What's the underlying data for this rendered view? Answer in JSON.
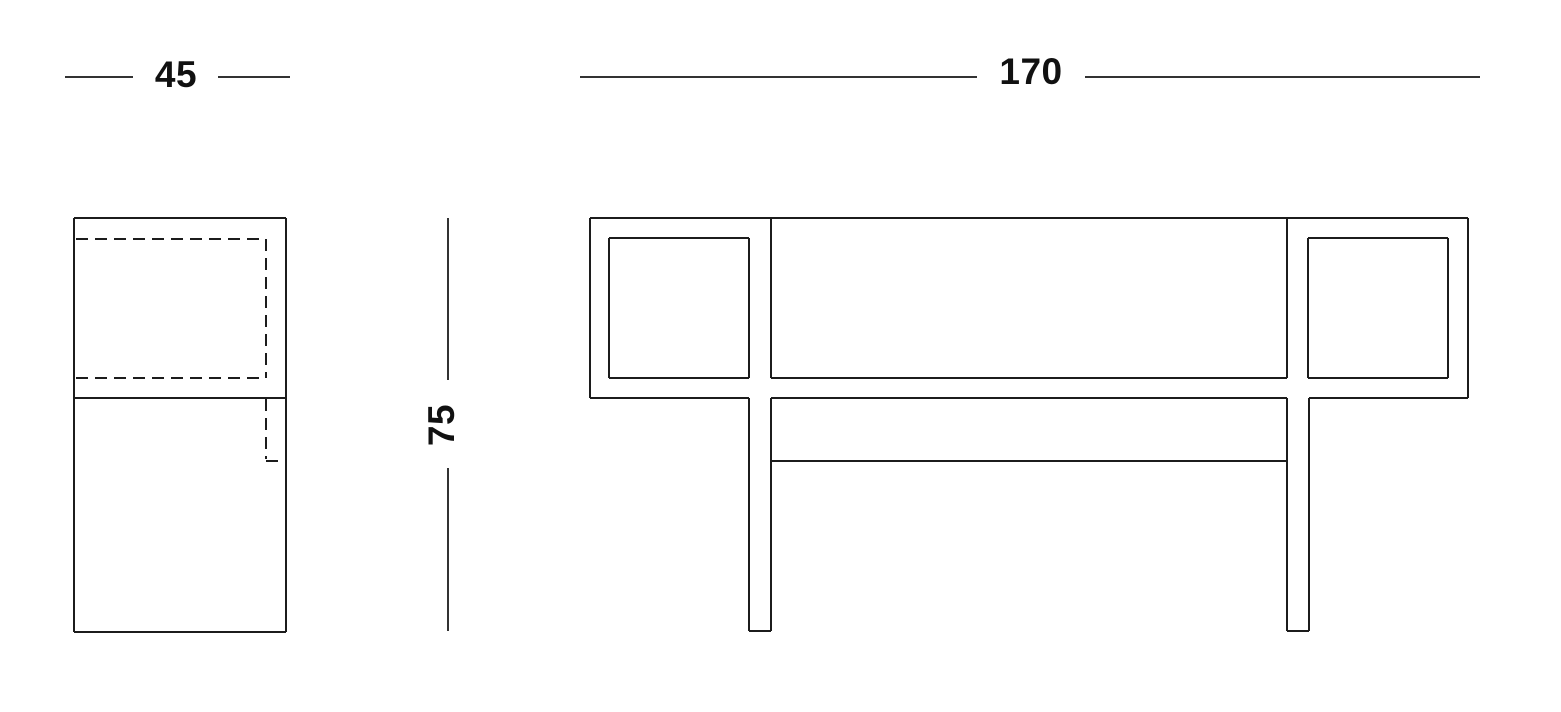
{
  "style": {
    "background": "#ffffff",
    "line_color": "#1c1c1c",
    "dim_line_color": "#333333",
    "text_color": "#111111"
  },
  "dimensions": {
    "depth": {
      "label": "45"
    },
    "length": {
      "label": "170"
    },
    "height": {
      "label": "75"
    }
  },
  "drawing": {
    "side_view": {
      "solid_lines": [
        {
          "x1": 74,
          "y1": 218,
          "x2": 286,
          "y2": 218
        },
        {
          "x1": 74,
          "y1": 218,
          "x2": 74,
          "y2": 632
        },
        {
          "x1": 286,
          "y1": 218,
          "x2": 286,
          "y2": 632
        },
        {
          "x1": 74,
          "y1": 398,
          "x2": 286,
          "y2": 398
        },
        {
          "x1": 74,
          "y1": 632,
          "x2": 286,
          "y2": 632
        }
      ],
      "dashed_lines": [
        {
          "x1": 76,
          "y1": 239,
          "x2": 266,
          "y2": 239
        },
        {
          "x1": 266,
          "y1": 239,
          "x2": 266,
          "y2": 378
        },
        {
          "x1": 76,
          "y1": 378,
          "x2": 266,
          "y2": 378
        },
        {
          "x1": 266,
          "y1": 399,
          "x2": 266,
          "y2": 459
        },
        {
          "x1": 266,
          "y1": 461,
          "x2": 286,
          "y2": 461
        }
      ]
    },
    "front_view": {
      "solid_lines": [
        {
          "x1": 590,
          "y1": 218,
          "x2": 1468,
          "y2": 218
        },
        {
          "x1": 590,
          "y1": 218,
          "x2": 590,
          "y2": 398
        },
        {
          "x1": 1468,
          "y1": 218,
          "x2": 1468,
          "y2": 398
        },
        {
          "x1": 590,
          "y1": 398,
          "x2": 749,
          "y2": 398
        },
        {
          "x1": 1309,
          "y1": 398,
          "x2": 1468,
          "y2": 398
        },
        {
          "x1": 609,
          "y1": 238,
          "x2": 749,
          "y2": 238
        },
        {
          "x1": 609,
          "y1": 238,
          "x2": 609,
          "y2": 378
        },
        {
          "x1": 749,
          "y1": 238,
          "x2": 749,
          "y2": 378
        },
        {
          "x1": 609,
          "y1": 378,
          "x2": 749,
          "y2": 378
        },
        {
          "x1": 1308,
          "y1": 238,
          "x2": 1448,
          "y2": 238
        },
        {
          "x1": 1308,
          "y1": 238,
          "x2": 1308,
          "y2": 378
        },
        {
          "x1": 1448,
          "y1": 238,
          "x2": 1448,
          "y2": 378
        },
        {
          "x1": 1308,
          "y1": 378,
          "x2": 1448,
          "y2": 378
        },
        {
          "x1": 771,
          "y1": 218,
          "x2": 771,
          "y2": 378
        },
        {
          "x1": 1287,
          "y1": 218,
          "x2": 1287,
          "y2": 378
        },
        {
          "x1": 771,
          "y1": 378,
          "x2": 1287,
          "y2": 378
        },
        {
          "x1": 771,
          "y1": 398,
          "x2": 1287,
          "y2": 398
        },
        {
          "x1": 771,
          "y1": 461,
          "x2": 1287,
          "y2": 461
        },
        {
          "x1": 749,
          "y1": 398,
          "x2": 749,
          "y2": 631
        },
        {
          "x1": 771,
          "y1": 398,
          "x2": 771,
          "y2": 631
        },
        {
          "x1": 749,
          "y1": 631,
          "x2": 771,
          "y2": 631
        },
        {
          "x1": 1287,
          "y1": 398,
          "x2": 1287,
          "y2": 631
        },
        {
          "x1": 1309,
          "y1": 398,
          "x2": 1309,
          "y2": 631
        },
        {
          "x1": 1287,
          "y1": 631,
          "x2": 1309,
          "y2": 631
        }
      ]
    },
    "dimension_lines": {
      "depth_segments": [
        {
          "x1": 65,
          "y1": 77,
          "x2": 133,
          "y2": 77
        },
        {
          "x1": 218,
          "y1": 77,
          "x2": 290,
          "y2": 77
        }
      ],
      "length_segments": [
        {
          "x1": 580,
          "y1": 77,
          "x2": 977,
          "y2": 77
        },
        {
          "x1": 1085,
          "y1": 77,
          "x2": 1480,
          "y2": 77
        }
      ],
      "height_segments": [
        {
          "x1": 448,
          "y1": 218,
          "x2": 448,
          "y2": 380
        },
        {
          "x1": 448,
          "y1": 468,
          "x2": 448,
          "y2": 631
        }
      ]
    }
  }
}
